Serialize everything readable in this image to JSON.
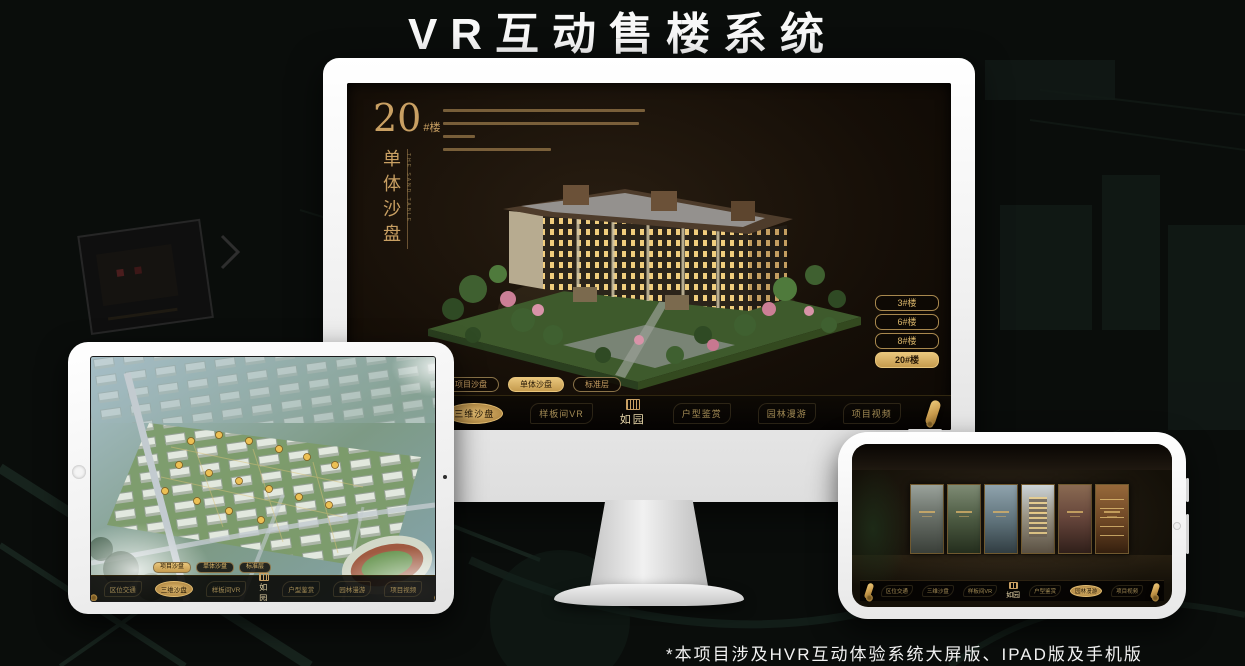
{
  "page": {
    "title": "VR互动售楼系统",
    "footnote": "*本项目涉及HVR互动体验系统大屏版、IPAD版及手机版"
  },
  "colors": {
    "background": "#0a0d0b",
    "gold": "#c9a063",
    "gold_active": "#e3bd72",
    "screen_dark": "#171008",
    "title_white": "#f8f8f8"
  },
  "monitor": {
    "block_number": "20",
    "block_unit": "#楼",
    "section_title": "单体沙盘",
    "section_title_en": "THE SAND TABLE",
    "floor_buttons": [
      {
        "label": "3#楼",
        "active": false
      },
      {
        "label": "6#楼",
        "active": false
      },
      {
        "label": "8#楼",
        "active": false
      },
      {
        "label": "20#楼",
        "active": true
      }
    ],
    "sub_tabs": [
      {
        "label": "项目沙盘",
        "active": false
      },
      {
        "label": "单体沙盘",
        "active": true
      },
      {
        "label": "标准层",
        "active": false
      }
    ],
    "nav_left": [
      {
        "label": "区位交通",
        "active": false
      },
      {
        "label": "三维沙盘",
        "active": true
      },
      {
        "label": "样板间VR",
        "active": false
      }
    ],
    "logo": "如园",
    "nav_right": [
      {
        "label": "户型鉴赏",
        "active": false
      },
      {
        "label": "园林漫游",
        "active": false
      },
      {
        "label": "项目视频",
        "active": false
      }
    ]
  },
  "tablet": {
    "sub_tabs": [
      {
        "label": "项目沙盘",
        "active": true
      },
      {
        "label": "单体沙盘",
        "active": false
      },
      {
        "label": "标准层",
        "active": false
      }
    ],
    "nav_left": [
      {
        "label": "区位交通",
        "active": false
      },
      {
        "label": "三维沙盘",
        "active": true
      },
      {
        "label": "样板间VR",
        "active": false
      }
    ],
    "logo": "如园",
    "nav_right": [
      {
        "label": "户型鉴赏",
        "active": false
      },
      {
        "label": "园林漫游",
        "active": false
      },
      {
        "label": "项目视频",
        "active": false
      }
    ]
  },
  "phone": {
    "nav_left": [
      {
        "label": "区位交通",
        "active": false
      },
      {
        "label": "三维沙盘",
        "active": false
      },
      {
        "label": "样板间VR",
        "active": false
      }
    ],
    "logo": "如园",
    "nav_right": [
      {
        "label": "户型鉴赏",
        "active": false
      },
      {
        "label": "园林漫游",
        "active": true
      },
      {
        "label": "项目视频",
        "active": false
      }
    ]
  }
}
